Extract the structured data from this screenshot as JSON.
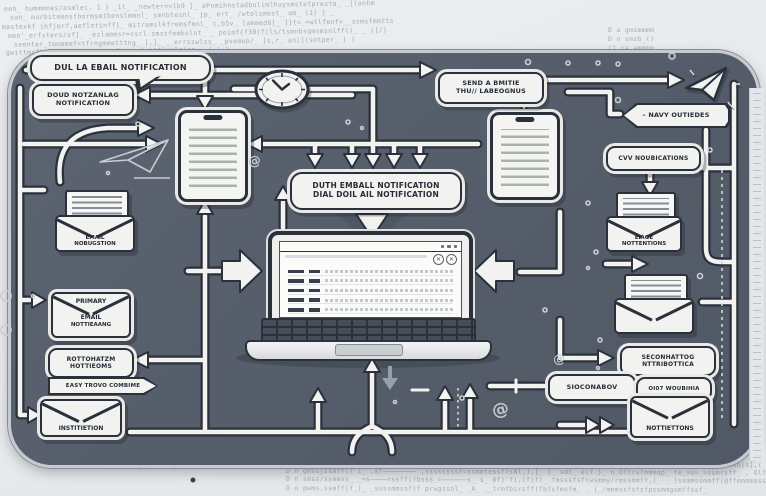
{
  "colors": {
    "panel": "#58606c",
    "ink": "#2b313a",
    "paper": "#f2f2f0",
    "background": "#e9ebed",
    "code_text": "#99a1a9"
  },
  "bg": {
    "top_lines": [
      "een_ hummmnes/asmlec, 1 } _il_ _newter==lb9 ]_ aPomihnstadbolimlhuysmstetpresta_ _[(anhm",
      "san_ murbitmensthormsmthenslmmnl_ smnbtesnl_ jp_ ert_ /wtolsmest_ um_ (1) ] _",
      "mastexkf ihfjmrf,aefletinff]_ mitremslkfremsfmnl_ c,b5v_ [ammed6]_ ]}t=_=wtlfenf=__ssmsfmmtts",
      "men'_erfsters/sf]_ _ezlammsr=ssrl.smssfembslnt_ _ poimf{f30(f)ls/tsmnbsqmsmsnlff()_ _ ([/)",
      "seenter_tmnmmef=tfrngmmetttng_ [,]_ _ errsswlss_ _pvemwp/_ ]s,r_ an([(smtper_ ) )",
      "gwittmrfb-lb_ _________==sfmssmsfsbttlnslmisn_ _( ( )"
    ],
    "top_right_lines": [
      "D  a  gmsmmmm",
      "D  n  smsb_()",
      "()  ra  ammmm_"
    ],
    "bottom_lines": [
      "D  n  pwsesssmsfbf(s_  .==ssssmmttf/fbssmmtsfs(ss=sss=  tsmffmmwms=ssssssssssmmmssf=ss—40smk_ _ swmmsbtsn_ _ hsb[s],( ]_ )",
      "D  n  gmssjssmff(f 1_  .sf————————  ,ssssssssf=ssmmtessffsNl,],[_ ]_  smt_ e(f }_  n_Oftrsfmmmqp_ te_=s=_=ssmrsff_ ,  Olff=f(s_ ] _ (s",
      "D  n  smss/ssmmss_  _=s————=ssff(fbsss_=——————s_  s_ 6f)'f),(f)f)_  fmsssfsftwsmmy/rmssmmff,(_ _ ]ssmmssmmff(@ffmmmmmssmsslf)_",
      "D  o  pwms,ssmff[f_)_  _ssssmmssf)f  prwgssnl_ _A_ __trmfbsrsff(fbfsfmsfm_ _ (_/memssfsfsfpssmmgsmffssf_"
    ],
    "bottom_note": "pwmlsbtg_  rasa_,  b(f}—_)"
  },
  "labels": {
    "bubble_top_left": "DUL LA EBAIL NOTIFICATION",
    "cloud_box": [
      "DOUD NOTZANLAG",
      "NOTIFICATION"
    ],
    "send_box": [
      "SEND A BMITIE",
      "THU// LABEOGNUS"
    ],
    "navy_banner": "– NAVY OUTIEDES",
    "cvv_box": "CVV NOUBICATIONS",
    "center_box": [
      "DUTH EMBALL NOTIFICATION",
      "DIAL DOIL AIL NOTIFICATION"
    ],
    "env_left": [
      "EMAIL",
      "NOBUGSTION"
    ],
    "primary_env": [
      "PRIMARY",
      "EMAIL",
      "NOTTIEAANG"
    ],
    "rot_box": [
      "ROTTOHATZM",
      "HOTTIEOMS"
    ],
    "easy_banner": "EASY TROVO COMBIME",
    "env_bottom_left": "INSTITIETION",
    "env_right1": [
      "EIAOE",
      "NOTTENTIONS"
    ],
    "sec2_box": [
      "SECONHATTOG",
      "NTTRIBOTTICA"
    ],
    "secon_box": "SIOCONABOV",
    "out_box": "OI07 WOUBIHIA",
    "env_bottom_right": "NOTTIETTONS",
    "window_close_glyph": "✕"
  },
  "icons": {
    "spiral_glyph": "@"
  }
}
